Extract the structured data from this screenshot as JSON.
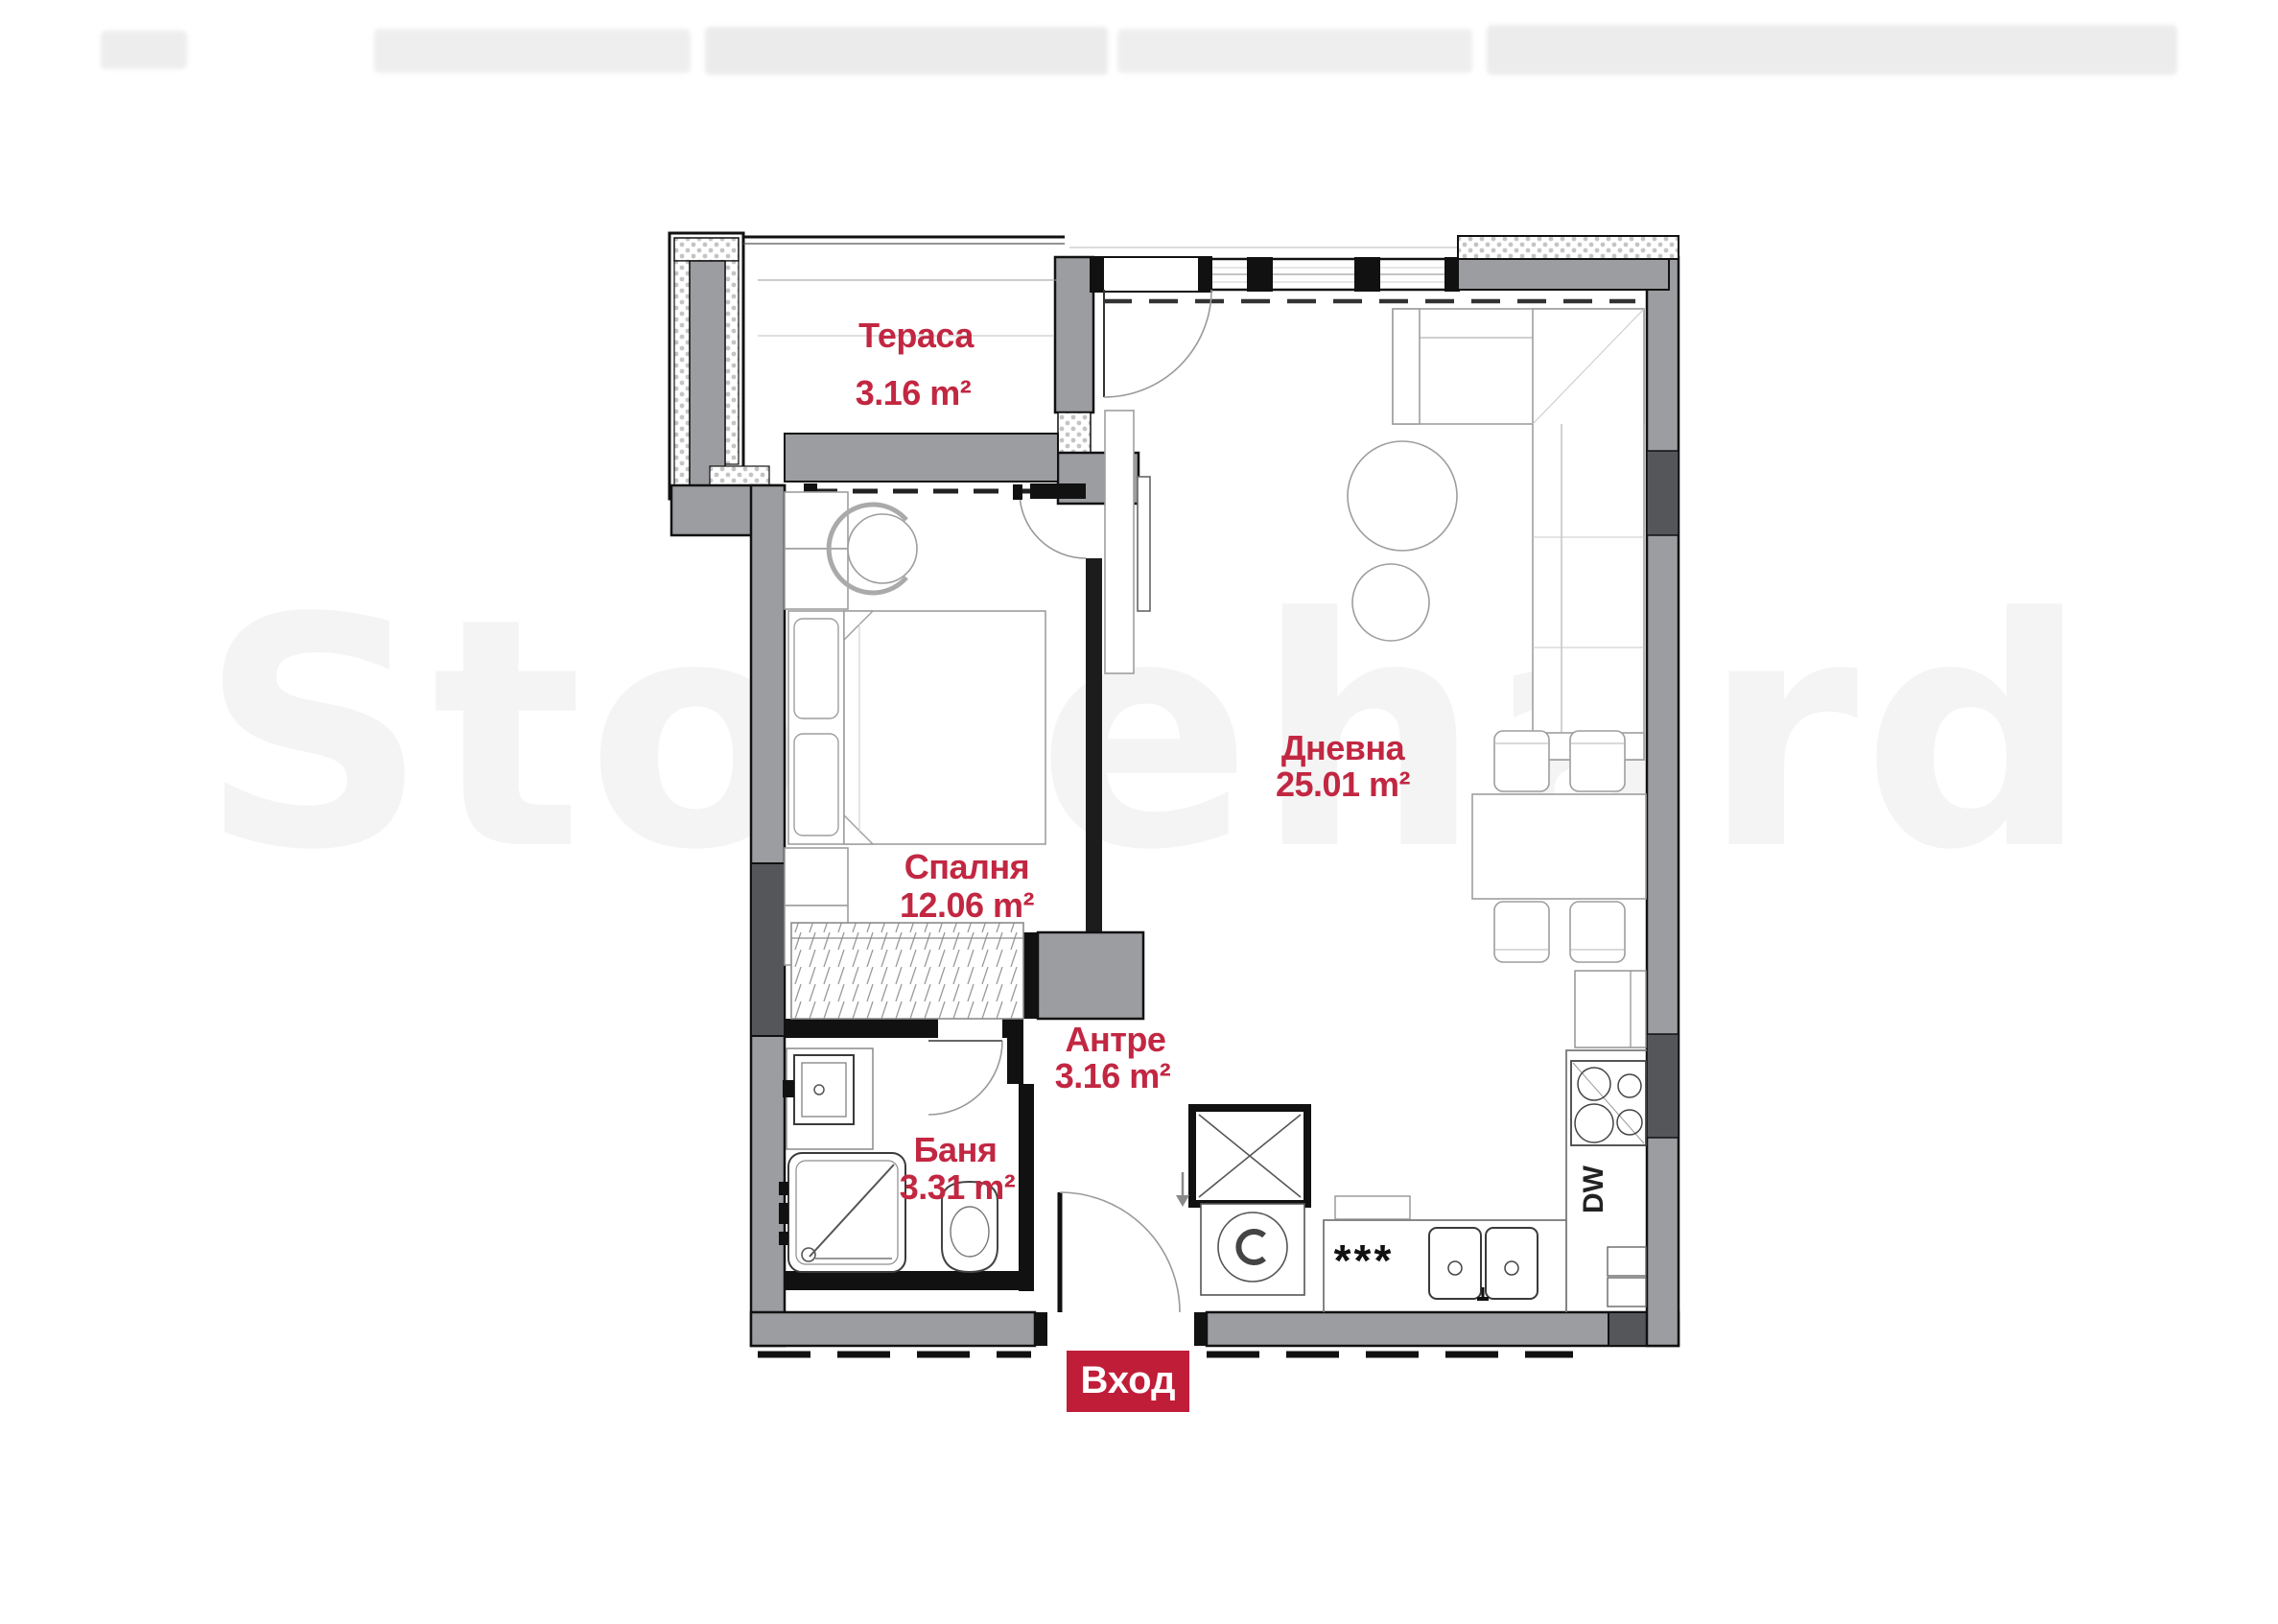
{
  "page": {
    "background": "#ffffff"
  },
  "watermark": {
    "text": "Stonehard"
  },
  "badge": {
    "label": "Вход",
    "bg": "#c01d39",
    "text_color": "#ffffff"
  },
  "rooms": [
    {
      "id": "terrace",
      "name": "Тераса",
      "area": "3.16 m²"
    },
    {
      "id": "bedroom",
      "name": "Спалня",
      "area": "12.06 m²"
    },
    {
      "id": "living",
      "name": "Дневна",
      "area": "25.01 m²"
    },
    {
      "id": "hallway",
      "name": "Антре",
      "area": "3.16 m²"
    },
    {
      "id": "bathroom",
      "name": "Баня",
      "area": "3.31 m²"
    }
  ],
  "labels": {
    "dishwasher": "DW",
    "stove": "***"
  },
  "colors": {
    "label_red": "#c22742",
    "badge_red": "#c01d39",
    "wall_gray": "#9b9da0",
    "wall_dark": "#54565a",
    "wall_black": "#111111",
    "furniture_line": "#9e9e9e"
  }
}
